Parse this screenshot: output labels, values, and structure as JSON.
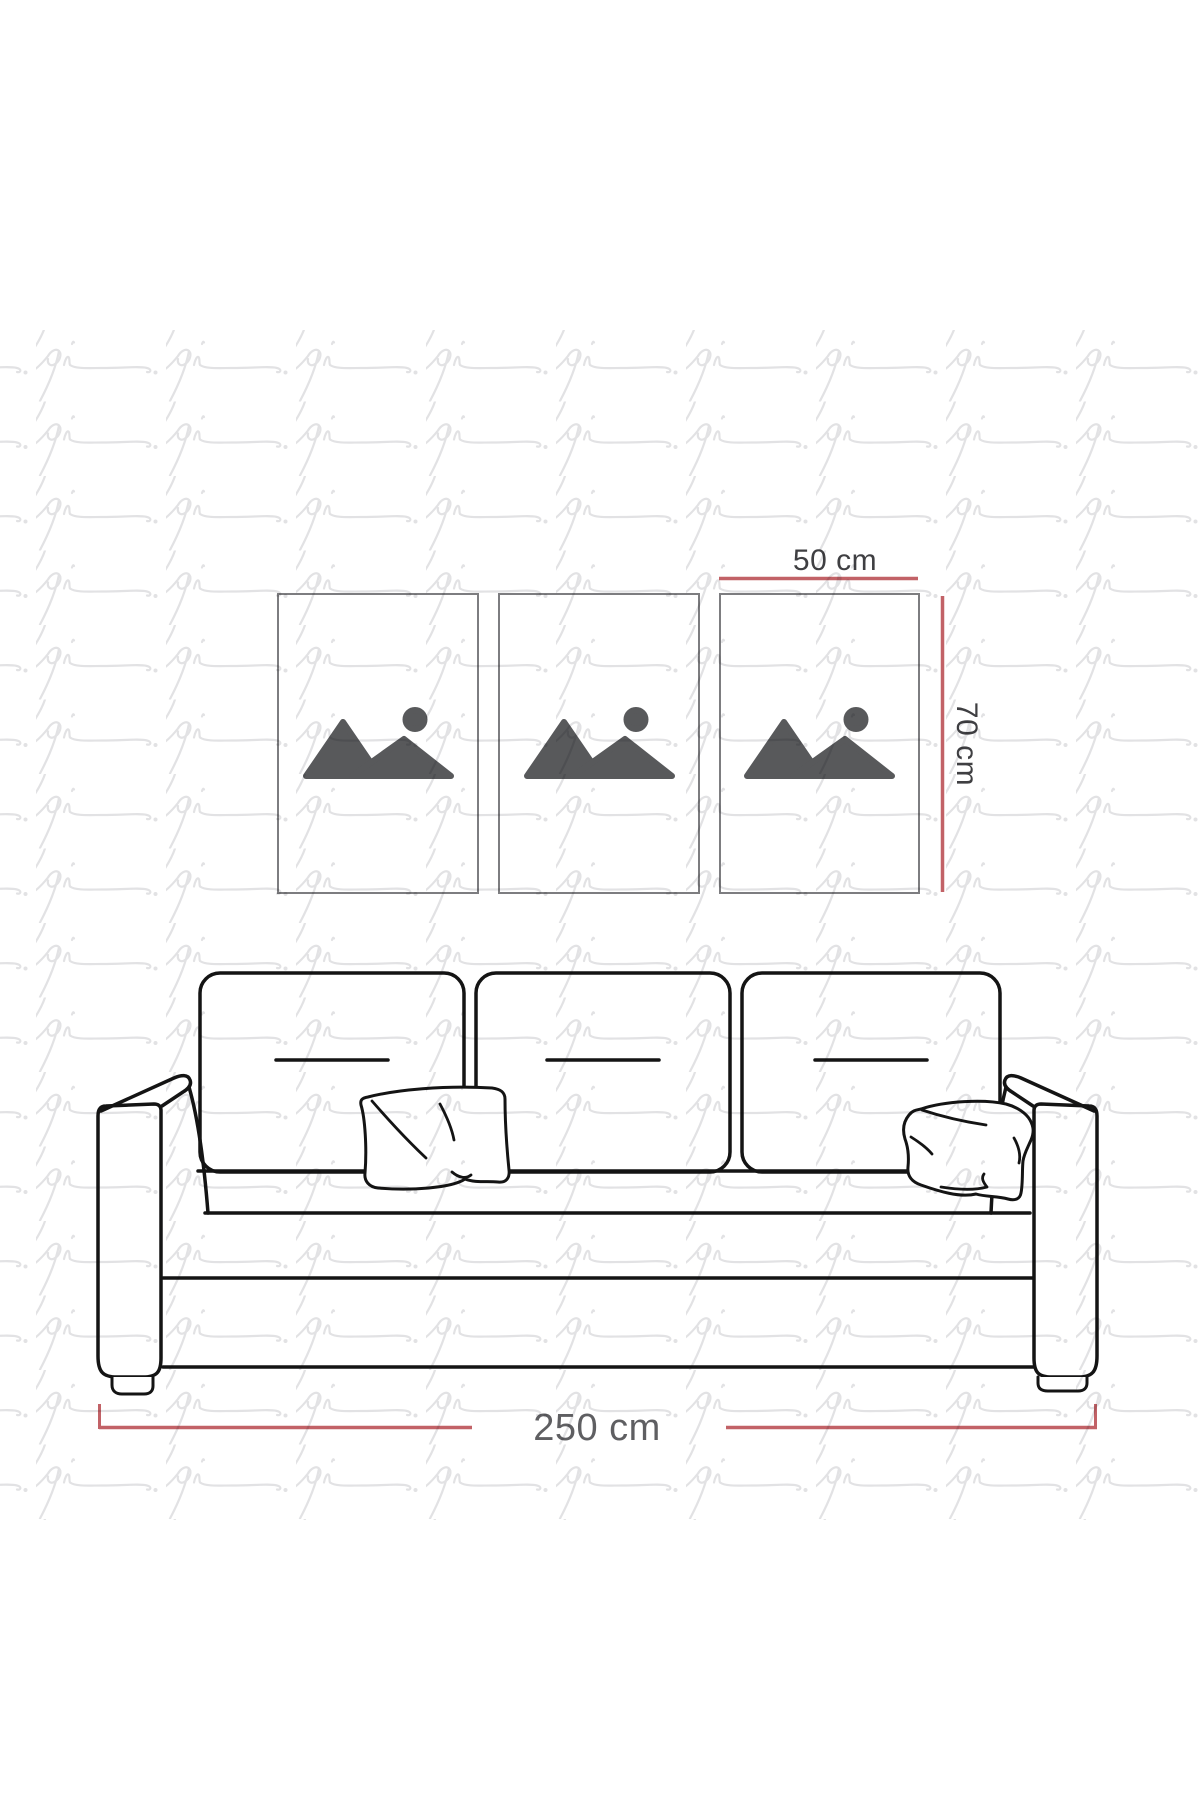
{
  "watermark": {
    "text": "pi",
    "color": "#e2e2e4"
  },
  "frames": {
    "border_color": "#7d7d80",
    "fill_color": "#ffffff",
    "icon_color": "#58595b",
    "items": [
      {
        "name": "frame-1"
      },
      {
        "name": "frame-2"
      },
      {
        "name": "frame-3"
      }
    ]
  },
  "dimensions": {
    "line_color": "#c26267",
    "frame_width_label": "50 cm",
    "frame_height_label": "70 cm",
    "sofa_width_label": "250 cm",
    "frame_label_color": "#3f3f42",
    "sofa_label_color": "#5f5f62"
  },
  "sofa": {
    "outline_color": "#141414",
    "back_cushions": 3,
    "throw_pillows": 2
  }
}
